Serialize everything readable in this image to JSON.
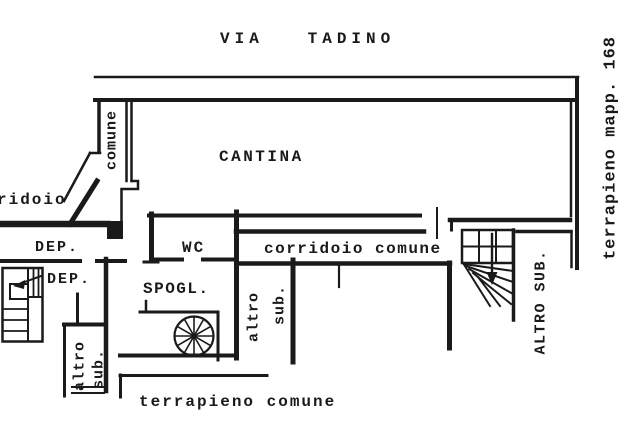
{
  "colors": {
    "ink": "#1a1a1a",
    "paper": "#ffffff"
  },
  "labels": {
    "via_tadino": "VIA   TADINO",
    "terrapieno_mapp": "terrapieno mapp. 168",
    "comune_vertical": "comune",
    "ridoio": "ridoio",
    "cantina": "CANTINA",
    "dep_upper": "DEP.",
    "dep_lower": "DEP.",
    "wc": "WC",
    "spogl": "SPOGL.",
    "corridoio_comune": "corridoio comune",
    "altro_left_line1": "altro",
    "altro_left_line2": "sub.",
    "altro_mid_line1": "altro",
    "altro_mid_line2": "sub.",
    "altro_sub_right": "ALTRO SUB.",
    "terrapieno_comune": "terrapieno comune"
  }
}
